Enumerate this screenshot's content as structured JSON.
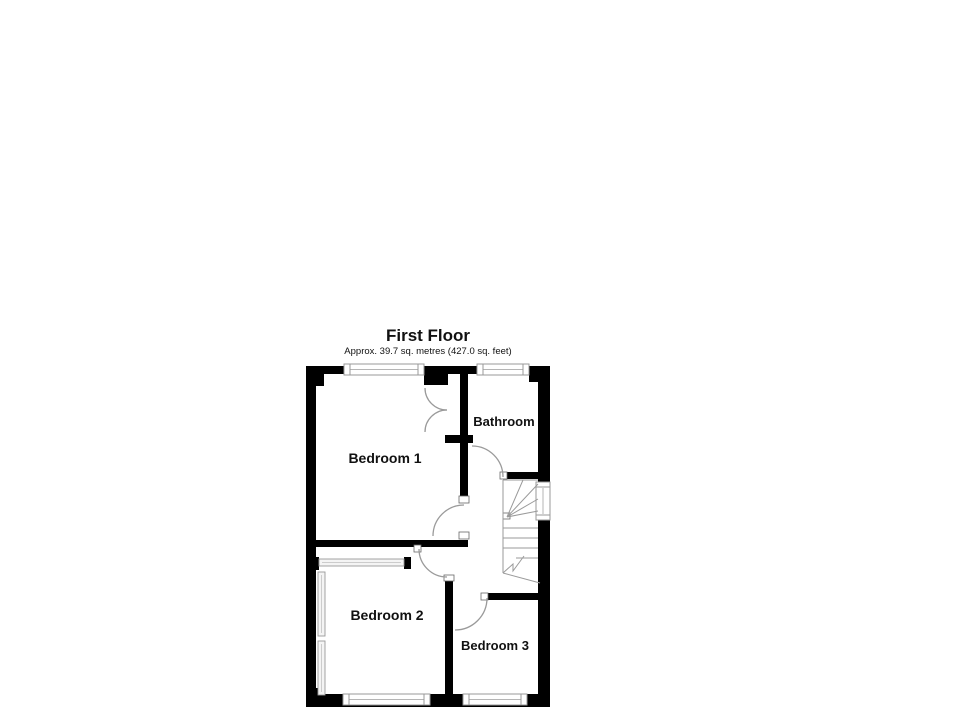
{
  "floorplan": {
    "title": "First Floor",
    "subtitle": "Approx. 39.7 sq. metres (427.0 sq. feet)",
    "rooms": [
      {
        "name": "bedroom-1",
        "label": "Bedroom 1"
      },
      {
        "name": "bathroom",
        "label": "Bathroom"
      },
      {
        "name": "bedroom-2",
        "label": "Bedroom 2"
      },
      {
        "name": "bedroom-3",
        "label": "Bedroom 3"
      }
    ],
    "colors": {
      "wall": "#000000",
      "line": "#9a9a9a",
      "text": "#111111",
      "background": "#ffffff"
    }
  }
}
